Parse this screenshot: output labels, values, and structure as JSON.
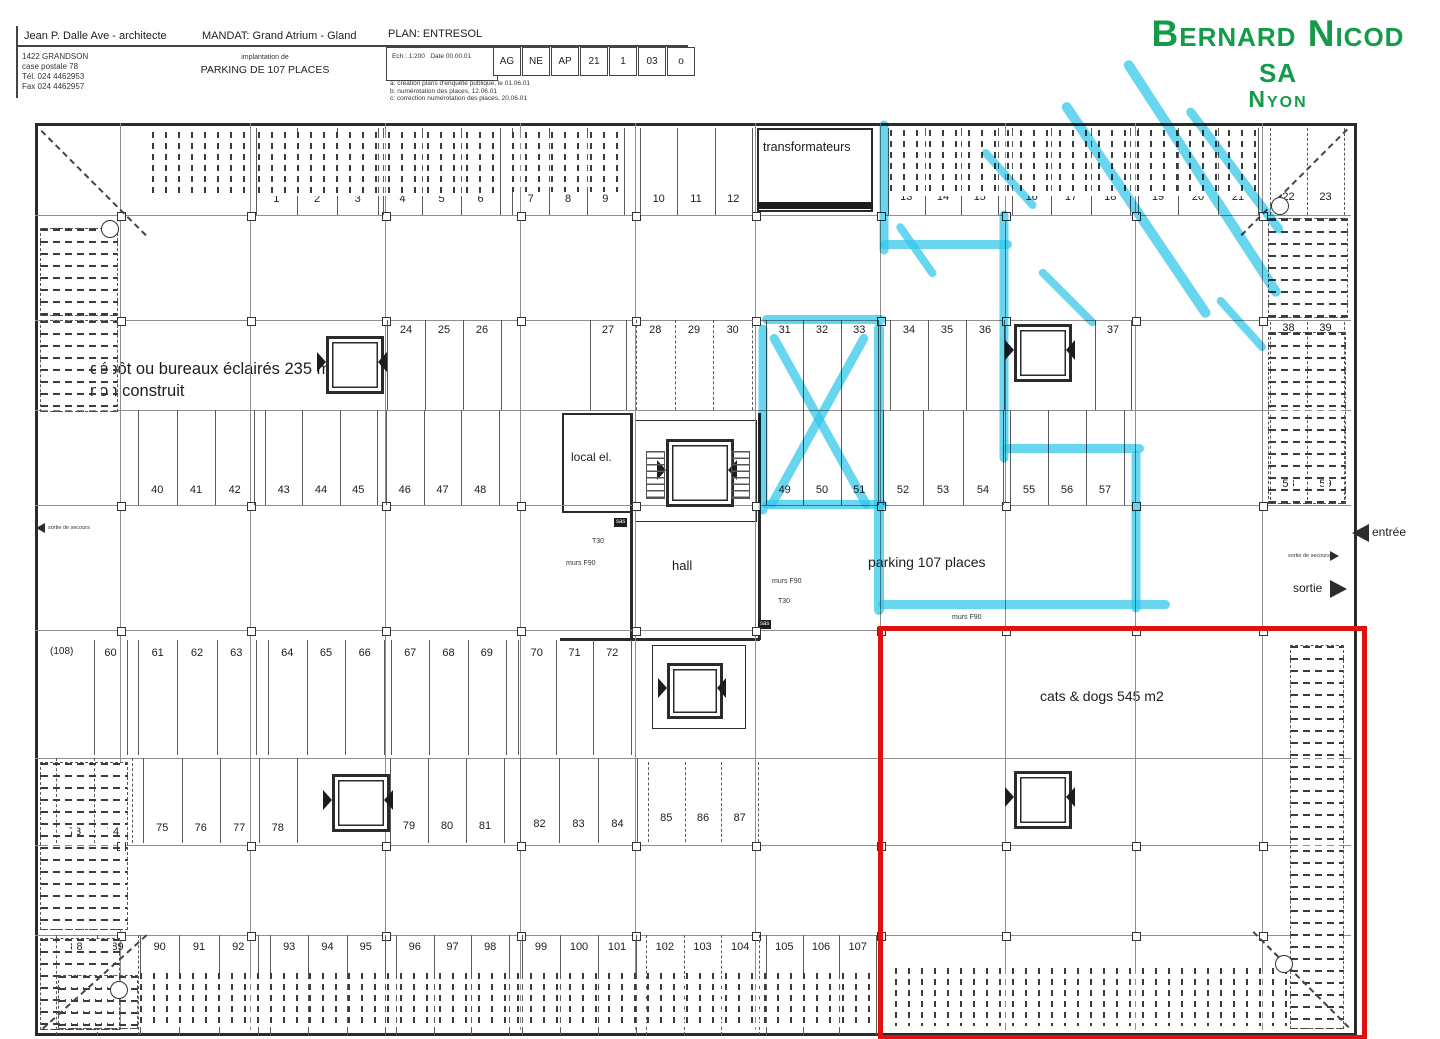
{
  "title_block": {
    "architect": "Jean P. Dalle Ave - architecte",
    "address": "1422 GRANDSON\ncase postale 78\nTél. 024 4462953\nFax 024 4462957",
    "mandat": "MANDAT: Grand Atrium - Gland",
    "plan_name": "PLAN: ENTRESOL",
    "project_sub": "implantation de",
    "project_title": "PARKING DE 107 PLACES",
    "scale": "Ech.: 1:200",
    "date": "Date 00.00.01",
    "code_cells": [
      "AG",
      "NE",
      "AP",
      "21",
      "1",
      "03",
      "o"
    ],
    "revisions": "a: création plans d'enquête publique, le 01.06.01\nb: numérotation des places, 12.06.01\nc: correction numérotation des places, 20.06.01"
  },
  "logo": {
    "name": "Bernard Nicod sa",
    "city": "Nyon",
    "color": "#149b49"
  },
  "plan": {
    "labels": {
      "transformateurs": "transformateurs",
      "depot_line1": "dépôt ou bureaux éclairés 235 m2",
      "depot_line2": "non construit",
      "local_el": "local el.",
      "hall": "hall",
      "parking": "parking 107 places",
      "cats_dogs": "cats & dogs 545 m2",
      "entree": "entrée",
      "sortie": "sortie",
      "sortie_secours": "sortie de secours",
      "murs_f90": "murs F90",
      "t30": "T30",
      "sas": "sas",
      "extra_stall": "(108)"
    },
    "stall_groups": [
      {
        "nums": [
          "1",
          "2",
          "3"
        ],
        "x": 256,
        "w": 122,
        "bt": 128,
        "bh": 87,
        "ly": 193
      },
      {
        "nums": [
          "4",
          "5",
          "6"
        ],
        "x": 383,
        "w": 117,
        "bt": 128,
        "bh": 87,
        "ly": 193
      },
      {
        "nums": [
          "7",
          "8",
          "9"
        ],
        "x": 512,
        "w": 112,
        "bt": 128,
        "bh": 87,
        "ly": 193
      },
      {
        "nums": [
          "10",
          "11",
          "12"
        ],
        "x": 640,
        "w": 112,
        "bt": 128,
        "bh": 87,
        "ly": 193
      },
      {
        "nums": [
          "13",
          "14",
          "15"
        ],
        "x": 888,
        "w": 110,
        "bt": 128,
        "bh": 87,
        "ly": 191
      },
      {
        "nums": [
          "16",
          "17",
          "18"
        ],
        "x": 1012,
        "w": 118,
        "bt": 128,
        "bh": 87,
        "ly": 191
      },
      {
        "nums": [
          "19",
          "20",
          "21"
        ],
        "x": 1138,
        "w": 120,
        "bt": 128,
        "bh": 87,
        "ly": 191
      },
      {
        "nums": [
          "22",
          "23"
        ],
        "x": 1270,
        "w": 74,
        "bt": 128,
        "bh": 87,
        "ly": 191,
        "dash": true
      },
      {
        "nums": [
          "24",
          "25",
          "26"
        ],
        "x": 387,
        "w": 114,
        "bt": 320,
        "bh": 90,
        "ly": 324
      },
      {
        "nums": [
          "27"
        ],
        "x": 590,
        "w": 36,
        "bt": 320,
        "bh": 90,
        "ly": 324
      },
      {
        "nums": [
          "28",
          "29",
          "30"
        ],
        "x": 636,
        "w": 116,
        "bt": 320,
        "bh": 90,
        "ly": 324,
        "dash": true
      },
      {
        "nums": [
          "31",
          "32",
          "33"
        ],
        "x": 766,
        "w": 112,
        "bt": 320,
        "bh": 90,
        "ly": 324
      },
      {
        "nums": [
          "34",
          "35",
          "36"
        ],
        "x": 890,
        "w": 114,
        "bt": 320,
        "bh": 90,
        "ly": 324
      },
      {
        "nums": [
          "37"
        ],
        "x": 1095,
        "w": 36,
        "bt": 320,
        "bh": 90,
        "ly": 324
      },
      {
        "nums": [
          "38",
          "39"
        ],
        "x": 1270,
        "w": 74,
        "bt": 322,
        "bh": 86,
        "ly": 322,
        "dash": true
      },
      {
        "nums": [
          "40",
          "41",
          "42"
        ],
        "x": 138,
        "w": 116,
        "bt": 410,
        "bh": 95,
        "ly": 484
      },
      {
        "nums": [
          "43",
          "44",
          "45"
        ],
        "x": 265,
        "w": 112,
        "bt": 410,
        "bh": 95,
        "ly": 484
      },
      {
        "nums": [
          "46",
          "47",
          "48"
        ],
        "x": 386,
        "w": 113,
        "bt": 410,
        "bh": 95,
        "ly": 484
      },
      {
        "nums": [
          "49",
          "50",
          "51"
        ],
        "x": 766,
        "w": 112,
        "bt": 410,
        "bh": 95,
        "ly": 484
      },
      {
        "nums": [
          "52",
          "53",
          "54"
        ],
        "x": 883,
        "w": 120,
        "bt": 410,
        "bh": 95,
        "ly": 484
      },
      {
        "nums": [
          "55",
          "56",
          "57"
        ],
        "x": 1010,
        "w": 114,
        "bt": 410,
        "bh": 95,
        "ly": 484
      },
      {
        "nums": [
          "58",
          "59"
        ],
        "x": 1270,
        "w": 74,
        "bt": 415,
        "bh": 85,
        "ly": 478,
        "dash": true
      },
      {
        "nums": [
          "60"
        ],
        "x": 94,
        "w": 33,
        "bt": 640,
        "bh": 115,
        "ly": 647
      },
      {
        "nums": [
          "61",
          "62",
          "63"
        ],
        "x": 138,
        "w": 118,
        "bt": 640,
        "bh": 115,
        "ly": 647
      },
      {
        "nums": [
          "64",
          "65",
          "66"
        ],
        "x": 268,
        "w": 116,
        "bt": 640,
        "bh": 115,
        "ly": 647
      },
      {
        "nums": [
          "67",
          "68",
          "69"
        ],
        "x": 391,
        "w": 115,
        "bt": 640,
        "bh": 115,
        "ly": 647
      },
      {
        "nums": [
          "70",
          "71",
          "72"
        ],
        "x": 518,
        "w": 113,
        "bt": 640,
        "bh": 115,
        "ly": 647
      },
      {
        "nums": [
          "73",
          "74"
        ],
        "x": 56,
        "w": 76,
        "bt": 758,
        "bh": 85,
        "ly": 826,
        "dash": true
      },
      {
        "nums": [
          "75",
          "76",
          "77",
          "78"
        ],
        "x": 143,
        "w": 154,
        "bt": 758,
        "bh": 85,
        "ly": 822
      },
      {
        "nums": [
          "79",
          "80",
          "81"
        ],
        "x": 390,
        "w": 114,
        "bt": 758,
        "bh": 85,
        "ly": 820
      },
      {
        "nums": [
          "82",
          "83",
          "84"
        ],
        "x": 520,
        "w": 117,
        "bt": 758,
        "bh": 85,
        "ly": 818
      },
      {
        "nums": [
          "85",
          "86",
          "87"
        ],
        "x": 648,
        "w": 110,
        "bt": 762,
        "bh": 80,
        "ly": 812,
        "dash": true
      },
      {
        "nums": [
          "88",
          "89"
        ],
        "x": 56,
        "w": 82,
        "bt": 935,
        "bh": 100,
        "ly": 941,
        "dash": true
      },
      {
        "nums": [
          "90",
          "91",
          "92"
        ],
        "x": 140,
        "w": 118,
        "bt": 935,
        "bh": 100,
        "ly": 941
      },
      {
        "nums": [
          "93",
          "94",
          "95"
        ],
        "x": 270,
        "w": 115,
        "bt": 935,
        "bh": 100,
        "ly": 941
      },
      {
        "nums": [
          "96",
          "97",
          "98"
        ],
        "x": 396,
        "w": 113,
        "bt": 935,
        "bh": 100,
        "ly": 941
      },
      {
        "nums": [
          "99",
          "100",
          "101"
        ],
        "x": 522,
        "w": 114,
        "bt": 935,
        "bh": 100,
        "ly": 941
      },
      {
        "nums": [
          "102",
          "103",
          "104"
        ],
        "x": 646,
        "w": 113,
        "bt": 935,
        "bh": 100,
        "ly": 941,
        "dash": true
      },
      {
        "nums": [
          "105",
          "106",
          "107"
        ],
        "x": 766,
        "w": 110,
        "bt": 935,
        "bh": 100,
        "ly": 941
      }
    ]
  },
  "annotations": {
    "highlight_color": "#2fc6ea",
    "outline_color": "#de1310",
    "strokes": [
      {
        "x": 884,
        "y": 116,
        "a": 90,
        "l": 134,
        "w": 9
      },
      {
        "x": 880,
        "y": 240,
        "a": 0,
        "l": 132,
        "w": 9
      },
      {
        "x": 1004,
        "y": 206,
        "a": 90,
        "l": 252,
        "w": 9
      },
      {
        "x": 1002,
        "y": 444,
        "a": 0,
        "l": 142,
        "w": 9
      },
      {
        "x": 1136,
        "y": 446,
        "a": 90,
        "l": 162,
        "w": 9
      },
      {
        "x": 878,
        "y": 600,
        "a": 0,
        "l": 292,
        "w": 9
      },
      {
        "x": 879,
        "y": 318,
        "a": 90,
        "l": 292,
        "w": 10
      },
      {
        "x": 762,
        "y": 315,
        "a": 0,
        "l": 124,
        "w": 9
      },
      {
        "x": 763,
        "y": 320,
        "a": 90,
        "l": 190,
        "w": 9
      },
      {
        "x": 763,
        "y": 500,
        "a": 0,
        "l": 124,
        "w": 9
      },
      {
        "x": 772,
        "y": 330,
        "a": 61,
        "l": 198,
        "w": 9
      },
      {
        "x": 866,
        "y": 330,
        "a": 119,
        "l": 198,
        "w": 9
      },
      {
        "x": 1064,
        "y": 98,
        "a": 56,
        "l": 258,
        "w": 10
      },
      {
        "x": 1126,
        "y": 56,
        "a": 57,
        "l": 280,
        "w": 10
      },
      {
        "x": 1188,
        "y": 104,
        "a": 53,
        "l": 155,
        "w": 9
      },
      {
        "x": 983,
        "y": 146,
        "a": 48,
        "l": 78,
        "w": 8
      },
      {
        "x": 1040,
        "y": 266,
        "a": 45,
        "l": 78,
        "w": 8
      },
      {
        "x": 898,
        "y": 220,
        "a": 55,
        "l": 64,
        "w": 8
      },
      {
        "x": 1218,
        "y": 294,
        "a": 48,
        "l": 70,
        "w": 8
      }
    ],
    "red_box": {
      "x": 878,
      "y": 626,
      "w": 479,
      "h": 404
    }
  }
}
